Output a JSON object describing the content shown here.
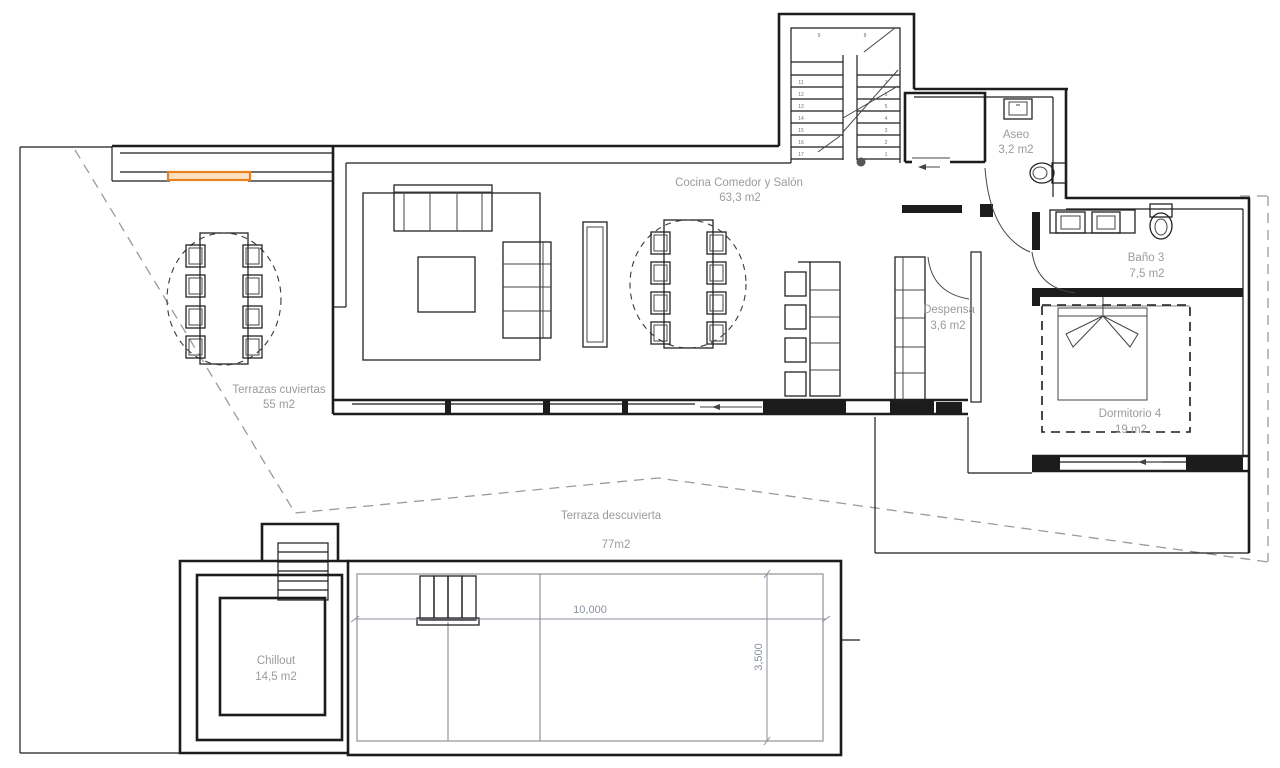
{
  "colors": {
    "wall": "#1c1c1c",
    "label": "#9b9b9b",
    "dim": "#8a929e",
    "accent": "#e8801f",
    "accent_fill": "#fde3c3",
    "boundary": "#9a9a9a"
  },
  "rooms": [
    {
      "id": "cocina",
      "label": "Cocina Comedor y Salón",
      "area": "63,3 m2"
    },
    {
      "id": "aseo",
      "label": "Aseo",
      "area": "3,2 m2"
    },
    {
      "id": "bano3",
      "label": "Baño 3",
      "area": "7,5 m2"
    },
    {
      "id": "despensa",
      "label": "Despensa",
      "area": "3,6 m2"
    },
    {
      "id": "dorm4",
      "label": "Dormitorio 4",
      "area": "19 m2"
    },
    {
      "id": "terr_cub",
      "label": "Terrazas cuviertas",
      "area": "55 m2"
    },
    {
      "id": "terr_desc",
      "label": "Terraza descuvierta",
      "area": "77m2"
    },
    {
      "id": "chillout",
      "label": "Chillout",
      "area": "14,5 m2"
    }
  ],
  "dimensions": {
    "pool_length": "10,000",
    "pool_width": "3,500"
  },
  "stairs": {
    "left_treads": [
      "11",
      "12",
      "13",
      "14",
      "15",
      "16",
      "17"
    ],
    "right_treads": [
      "7",
      "6",
      "5",
      "4",
      "3",
      "2",
      "1"
    ],
    "landing": [
      "9",
      "8"
    ]
  }
}
